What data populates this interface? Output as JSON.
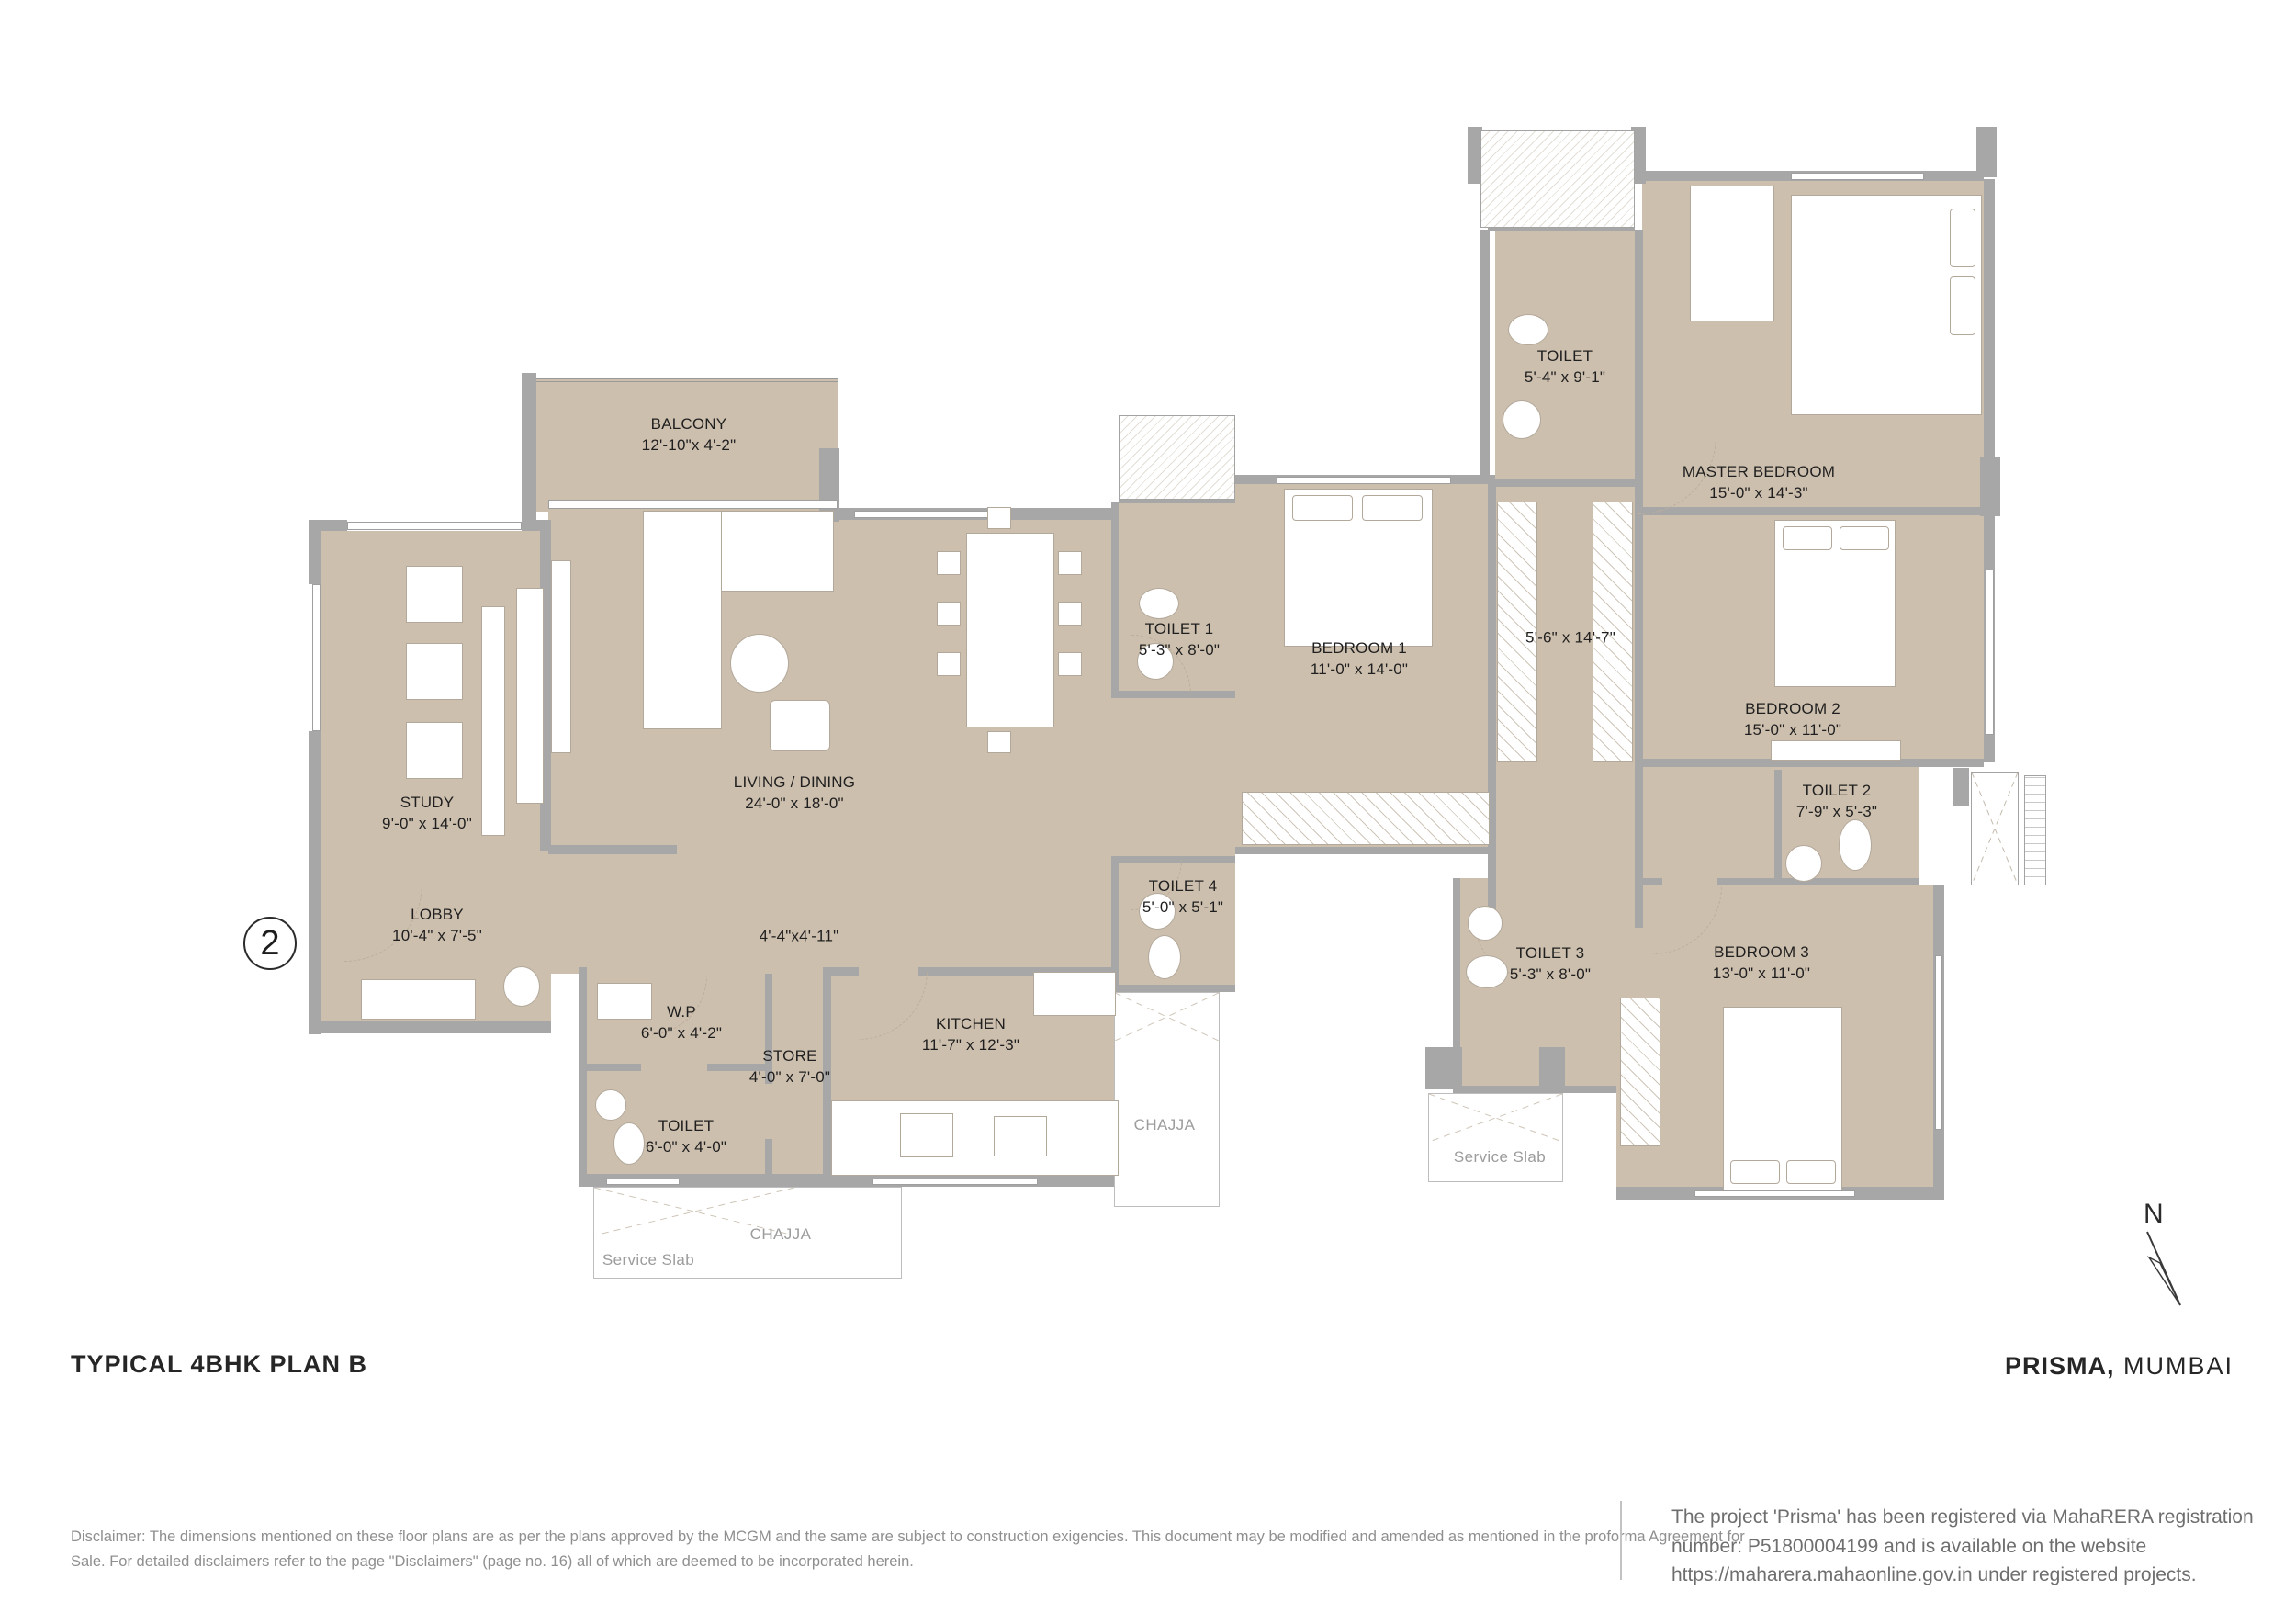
{
  "plan": {
    "unit_badge": "2",
    "north_label": "N"
  },
  "rooms": [
    {
      "id": "balcony",
      "name": "BALCONY",
      "dims": "12'-10\"x 4'-2\""
    },
    {
      "id": "living-dining",
      "name": "LIVING / DINING",
      "dims": "24'-0\" x 18'-0\""
    },
    {
      "id": "study",
      "name": "STUDY",
      "dims": "9'-0\" x 14'-0\""
    },
    {
      "id": "lobby",
      "name": "LOBBY",
      "dims": "10'-4\" x 7'-5\""
    },
    {
      "id": "wp",
      "name": "W.P",
      "dims": "6'-0\" x 4'-2\""
    },
    {
      "id": "store",
      "name": "STORE",
      "dims": "4'-0\" x 7'-0\""
    },
    {
      "id": "toilet-ground",
      "name": "TOILET",
      "dims": "6'-0\" x 4'-0\""
    },
    {
      "id": "kitchen",
      "name": "KITCHEN",
      "dims": "11'-7\" x 12'-3\""
    },
    {
      "id": "toilet-1",
      "name": "TOILET 1",
      "dims": "5'-3\" x 8'-0\""
    },
    {
      "id": "toilet-4",
      "name": "TOILET 4",
      "dims": "5'-0\" x 5'-1\""
    },
    {
      "id": "bedroom-1",
      "name": "BEDROOM 1",
      "dims": "11'-0\" x 14'-0\""
    },
    {
      "id": "toilet-master",
      "name": "TOILET",
      "dims": "5'-4\" x 9'-1\""
    },
    {
      "id": "master-bedroom",
      "name": "MASTER BEDROOM",
      "dims": "15'-0\" x 14'-3\""
    },
    {
      "id": "bedroom-2",
      "name": "BEDROOM 2",
      "dims": "15'-0\" x 11'-0\""
    },
    {
      "id": "toilet-2",
      "name": "TOILET 2",
      "dims": "7'-9\" x 5'-3\""
    },
    {
      "id": "toilet-3",
      "name": "TOILET 3",
      "dims": "5'-3\" x 8'-0\""
    },
    {
      "id": "bedroom-3",
      "name": "BEDROOM 3",
      "dims": "13'-0\" x 11'-0\""
    }
  ],
  "passages": [
    {
      "id": "wardrobe-passage",
      "dims": "5'-6\" x 14'-7\""
    },
    {
      "id": "inner-passage",
      "dims": "4'-4\"x4'-11\""
    }
  ],
  "annotations": {
    "chajja_left": "CHAJJA",
    "service_slab_left": "Service Slab",
    "chajja_mid": "CHAJJA",
    "service_slab_right": "Service Slab"
  },
  "footer": {
    "plan_title": "TYPICAL 4BHK PLAN B",
    "project_name": "PRISMA,",
    "project_city": "MUMBAI",
    "disclaimer_lines": [
      "Disclaimer: The dimensions mentioned on these floor plans are as per the plans approved by the MCGM and the same are subject to construction exigencies. This document may be modified and amended as mentioned in the proforma Agreement for",
      "Sale. For detailed disclaimers refer to the page \"Disclaimers\" (page no. 16) all of which are deemed to be incorporated herein."
    ],
    "rera_lines": [
      "The project 'Prisma' has been registered via MahaRERA registration",
      "number: P51800004199 and is available on the website",
      "https://maharera.mahaonline.gov.in under registered projects."
    ]
  },
  "colors": {
    "room_fill": "#cdbfae",
    "wall": "#a7a7a7",
    "label": "#1f1f1f",
    "muted": "#9c9c9c"
  }
}
